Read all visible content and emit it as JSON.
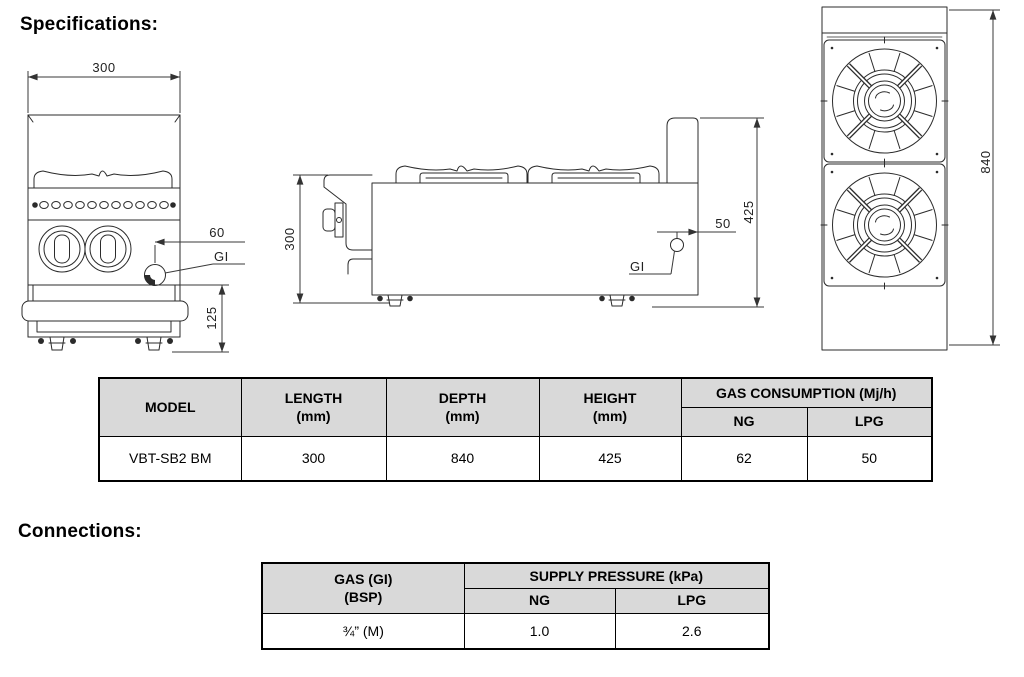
{
  "headings": {
    "specifications": "Specifications:",
    "connections": "Connections:"
  },
  "drawings": {
    "front_view": {
      "width_dim": "300",
      "inlet_offset_dim": "60",
      "inlet_label": "GI",
      "base_height_dim": "125"
    },
    "side_view": {
      "body_height_dim": "300",
      "inlet_offset_dim": "50",
      "overall_height_dim": "425",
      "inlet_label": "GI"
    },
    "top_view": {
      "depth_dim": "840"
    }
  },
  "spec_table": {
    "headers": {
      "model": "MODEL",
      "length": "LENGTH\n(mm)",
      "depth": "DEPTH\n(mm)",
      "height": "HEIGHT\n(mm)",
      "gas_consumption": "GAS CONSUMPTION (Mj/h)",
      "ng": "NG",
      "lpg": "LPG"
    },
    "rows": [
      {
        "model": "VBT-SB2 BM",
        "length": "300",
        "depth": "840",
        "height": "425",
        "ng": "62",
        "lpg": "50"
      }
    ]
  },
  "connections_table": {
    "headers": {
      "gas": "GAS (GI)\n(BSP)",
      "supply_pressure": "SUPPLY PRESSURE (kPa)",
      "ng": "NG",
      "lpg": "LPG"
    },
    "rows": [
      {
        "gas": "¾” (M)",
        "ng": "1.0",
        "lpg": "2.6"
      }
    ]
  },
  "colors": {
    "table_header_bg": "#d9d9d9",
    "line_color": "#2b2b2b",
    "text_color": "#000000"
  }
}
